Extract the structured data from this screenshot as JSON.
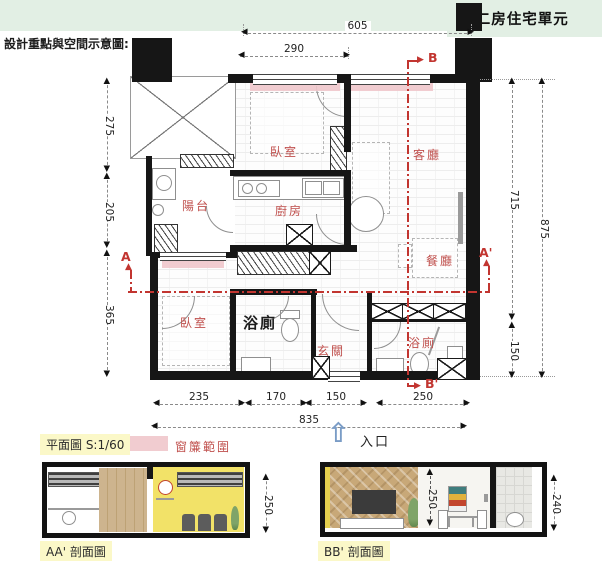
{
  "header": {
    "caption": "設計重點與空間示意圖:",
    "unit_title": "■ 二房住宅單元"
  },
  "rooms": {
    "bedroom1": "臥室",
    "living": "客廳",
    "balcony": "陽台",
    "kitchen": "廚房",
    "dining": "餐廳",
    "bedroom2": "臥室",
    "bath1": "浴廁",
    "foyer": "玄關",
    "bath2": "浴廁"
  },
  "markers": {
    "a": "A",
    "a_prime": "A'",
    "b": "B",
    "b_prime": "B'"
  },
  "dims": {
    "top_605": "605",
    "top_290": "290",
    "left_275": "275",
    "left_205": "205",
    "left_365": "365",
    "right_715": "715",
    "right_875": "875",
    "right_150": "150",
    "bottom_235": "235",
    "bottom_170": "170",
    "bottom_150": "150",
    "bottom_250": "250",
    "bottom_835": "835",
    "section_aa_250": "250",
    "section_bb_250": "250",
    "section_bb_240": "240"
  },
  "legend": {
    "plan_label": "平面圖 S:1/60",
    "curtain_label": "窗簾範圍",
    "entrance_label": "入口"
  },
  "sections": {
    "aa_label": "AA'  剖面圖",
    "bb_label": "BB'  剖面圖"
  },
  "icons": {
    "arrow_up": "▲",
    "arrow_down": "▼",
    "arrow_left": "◀",
    "arrow_right": "▶",
    "entrance_arrow": "⇧"
  },
  "colors": {
    "accent_red": "#c0504d",
    "section_red": "#c23530",
    "curtain_pink": "#efc7cb",
    "header_green": "#e2efe4",
    "highlight_yellow": "#fbf8c8",
    "entrance_blue": "#7a9cc6",
    "wall_black": "#161616",
    "section_wall_yellow": "#f2e268",
    "wood": "#cdb48e"
  }
}
